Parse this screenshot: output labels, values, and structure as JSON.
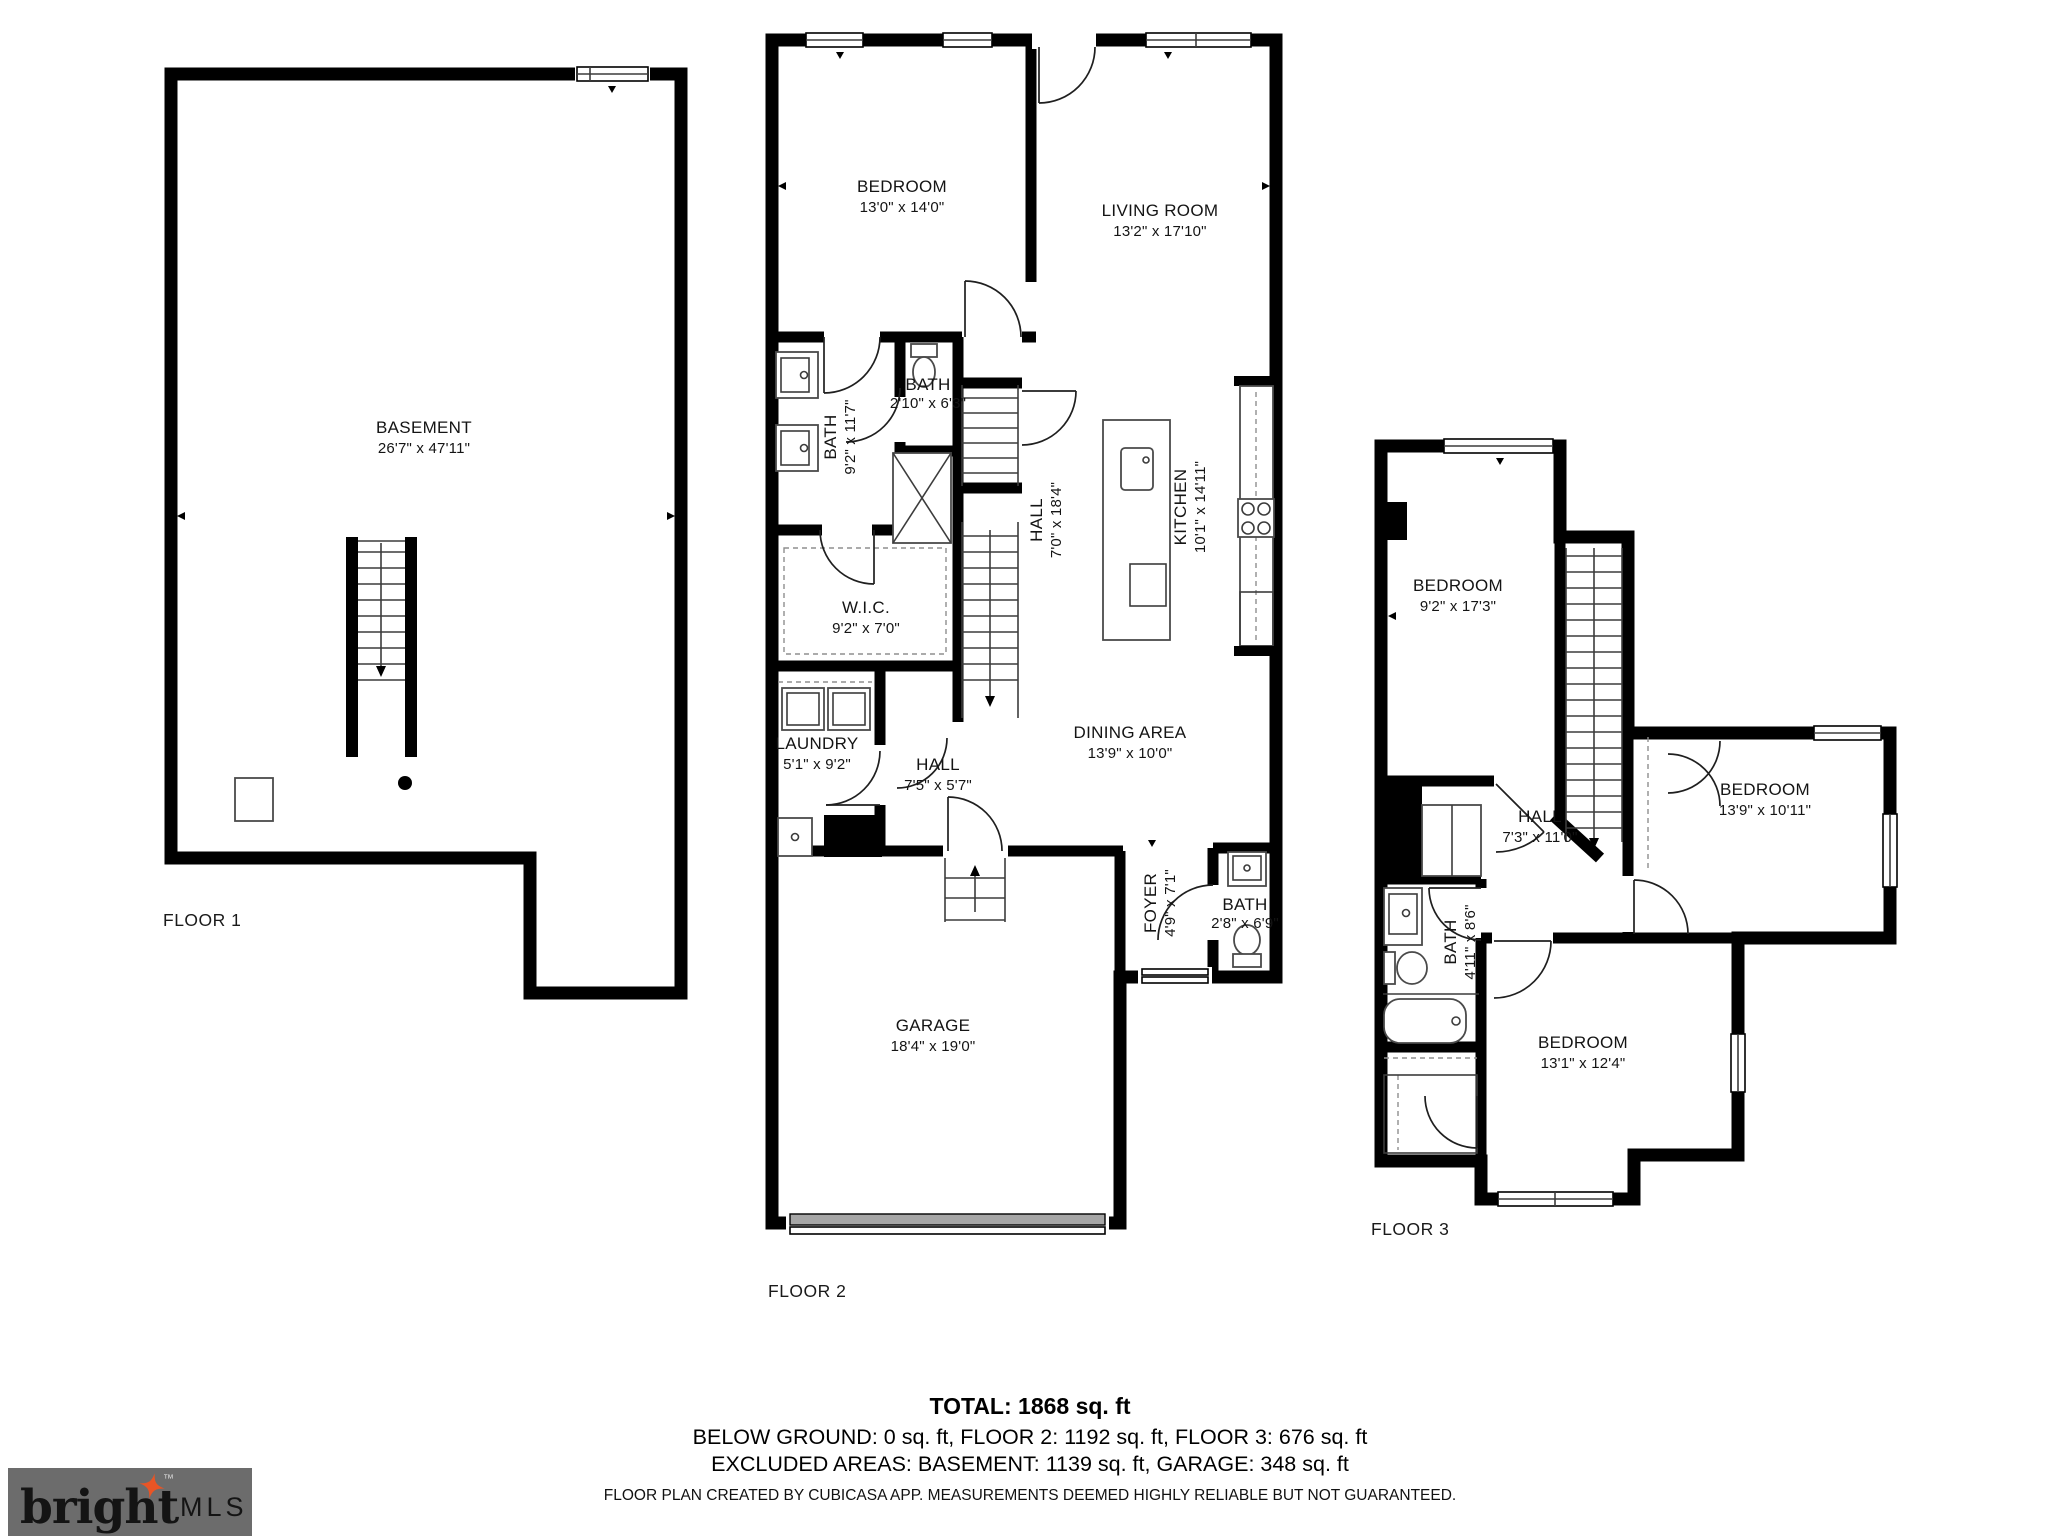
{
  "colors": {
    "wall": "#000000",
    "fixture_line": "#4a4a4a",
    "garage_door": "#a6a6a6",
    "logo_bg": "#6c6c6c",
    "logo_brand": "#f4f2ec",
    "logo_mls": "#c2c2c2",
    "logo_star": "#e85526"
  },
  "floors": [
    {
      "caption": "FLOOR 1",
      "rooms": [
        {
          "name": "BASEMENT",
          "dims": "26'7\" x 47'11\""
        }
      ]
    },
    {
      "caption": "FLOOR 2",
      "rooms": [
        {
          "name": "BEDROOM",
          "dims": "13'0\" x 14'0\""
        },
        {
          "name": "LIVING ROOM",
          "dims": "13'2\" x 17'10\""
        },
        {
          "name": "BATH",
          "dims": "9'2\" x 11'7\""
        },
        {
          "name": "BATH",
          "dims": "2'10\" x 6'3\""
        },
        {
          "name": "HALL",
          "dims": "7'0\" x 18'4\""
        },
        {
          "name": "KITCHEN",
          "dims": "10'1\" x 14'11\""
        },
        {
          "name": "W.I.C.",
          "dims": "9'2\" x 7'0\""
        },
        {
          "name": "LAUNDRY",
          "dims": "5'1\" x 9'2\""
        },
        {
          "name": "HALL",
          "dims": "7'5\" x 5'7\""
        },
        {
          "name": "DINING AREA",
          "dims": "13'9\" x 10'0\""
        },
        {
          "name": "FOYER",
          "dims": "4'9\" x 7'1\""
        },
        {
          "name": "BATH",
          "dims": "2'8\" x 6'9\""
        },
        {
          "name": "GARAGE",
          "dims": "18'4\" x 19'0\""
        }
      ]
    },
    {
      "caption": "FLOOR 3",
      "rooms": [
        {
          "name": "BEDROOM",
          "dims": "9'2\" x 17'3\""
        },
        {
          "name": "HALL",
          "dims": "7'3\" x 11'0\""
        },
        {
          "name": "BEDROOM",
          "dims": "13'9\" x 10'11\""
        },
        {
          "name": "BATH",
          "dims": "4'11\" x 8'6\""
        },
        {
          "name": "BEDROOM",
          "dims": "13'1\" x 12'4\""
        }
      ]
    }
  ],
  "summary": {
    "total": "TOTAL: 1868 sq. ft",
    "breakdown": "BELOW GROUND: 0 sq. ft, FLOOR 2: 1192 sq. ft, FLOOR 3: 676 sq. ft",
    "excluded": "EXCLUDED AREAS: BASEMENT: 1139 sq. ft, GARAGE: 348 sq. ft",
    "disclaimer": "FLOOR PLAN CREATED BY CUBICASA APP. MEASUREMENTS DEEMED HIGHLY RELIABLE BUT NOT GUARANTEED."
  },
  "logo": {
    "brand": "bright",
    "tm": "™",
    "suffix": "MLS"
  }
}
